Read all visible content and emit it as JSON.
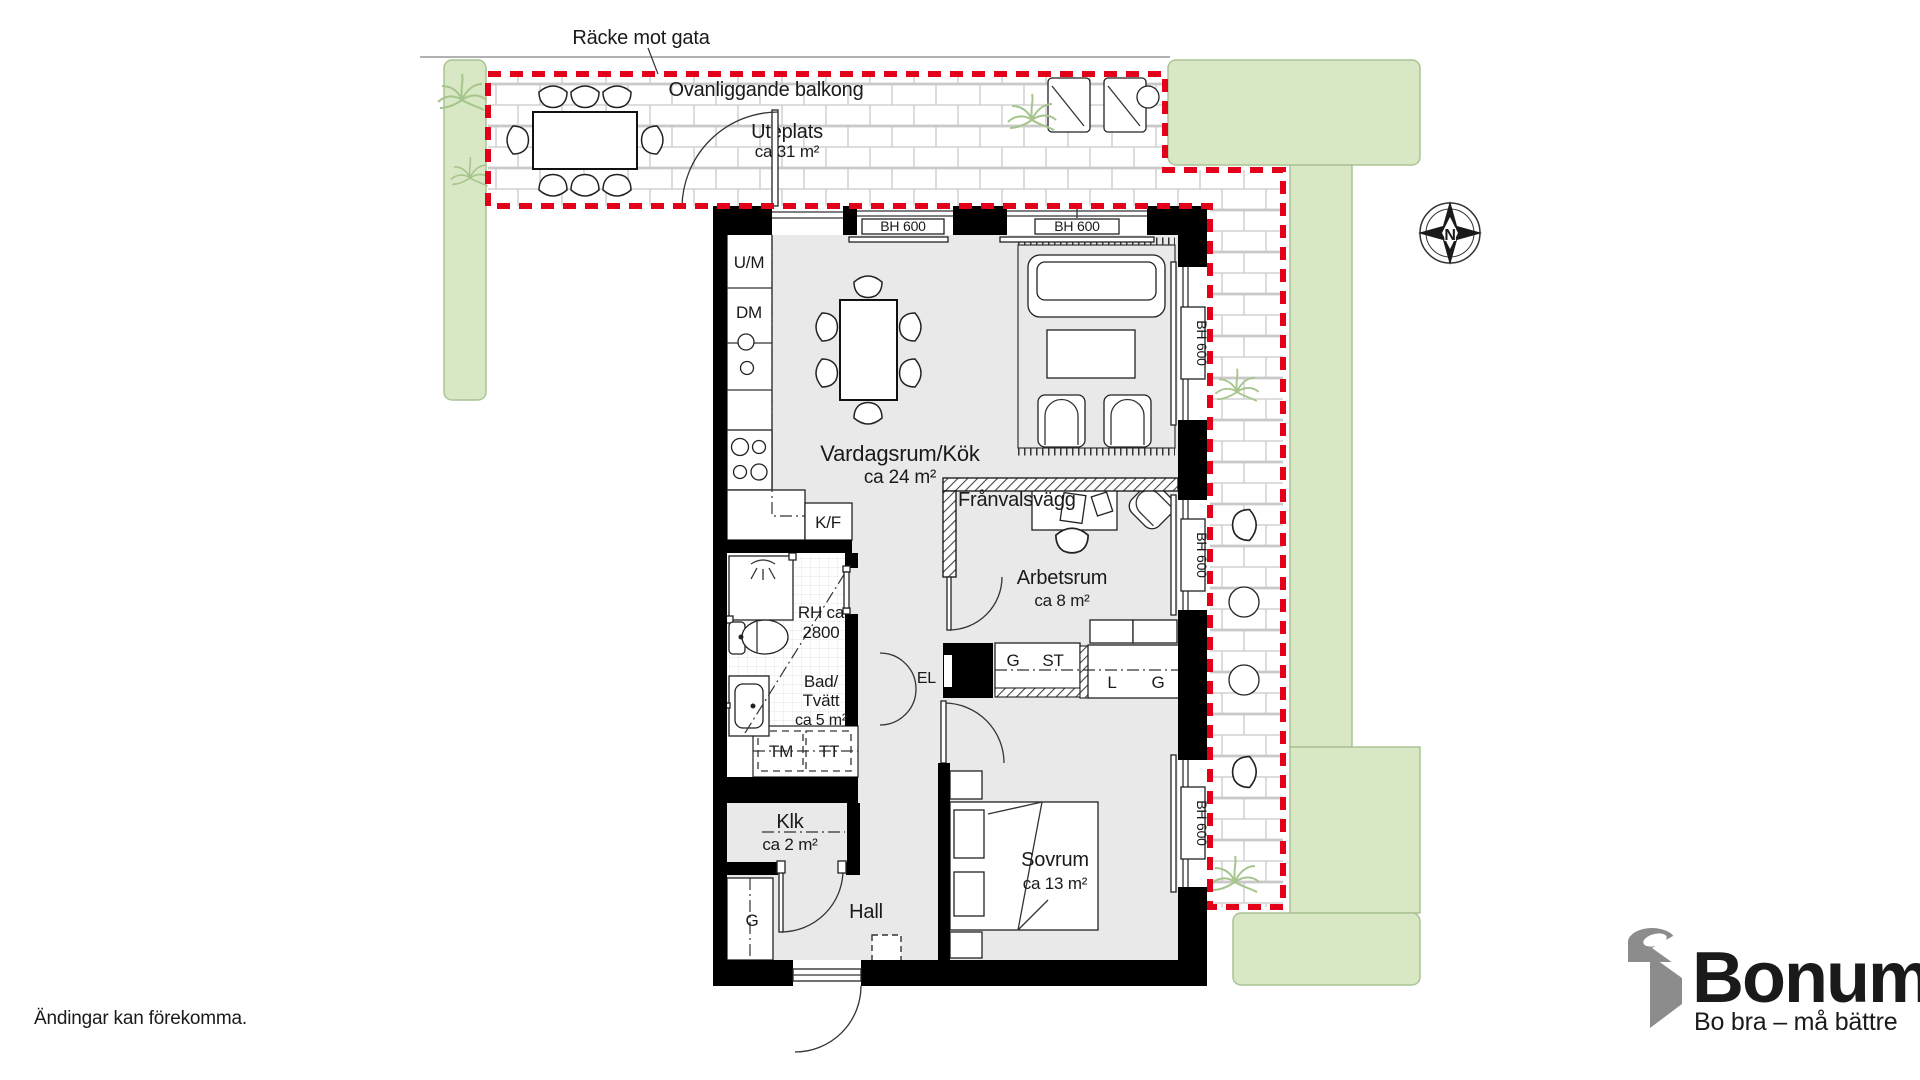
{
  "colors": {
    "accent_red": "#e3001b",
    "grass": "#d8e8c4",
    "grass_border": "#aac394",
    "floor_gray": "#e9e9e9",
    "wall_black": "#000000",
    "brick_line": "#c9c9c9",
    "brand_orange": "#f7a31e",
    "brand_gray": "#8c8c8c"
  },
  "labels": {
    "racke_mot_gata": "Räcke mot gata",
    "ovanliggande_balkong": "Ovanliggande balkong",
    "uteplats": "Uteplats",
    "uteplats_area": "ca 31 m²",
    "bh600": "BH 600",
    "um": "U/M",
    "dm": "DM",
    "kf": "K/F",
    "vardagsrum": "Vardagsrum/Kök",
    "vardagsrum_area": "ca 24 m²",
    "franvalsvagg": "Frånvalsvägg",
    "arbetsrum": "Arbetsrum",
    "arbetsrum_area": "ca 8 m²",
    "rh_line1": "RH ca",
    "rh_line2": "2800",
    "bad_line1": "Bad/",
    "bad_line2": "Tvätt",
    "bad_area": "ca 5 m²",
    "tm": "TM",
    "tt": "TT",
    "el": "EL",
    "g": "G",
    "st": "ST",
    "l": "L",
    "klk": "Klk",
    "klk_area": "ca 2 m²",
    "hall": "Hall",
    "sovrum": "Sovrum",
    "sovrum_area": "ca 13 m²",
    "north": "N"
  },
  "branding": {
    "name": "Bonum",
    "tagline": "Bo bra – må bättre"
  },
  "disclaimer": "Ändingar kan förekomma."
}
